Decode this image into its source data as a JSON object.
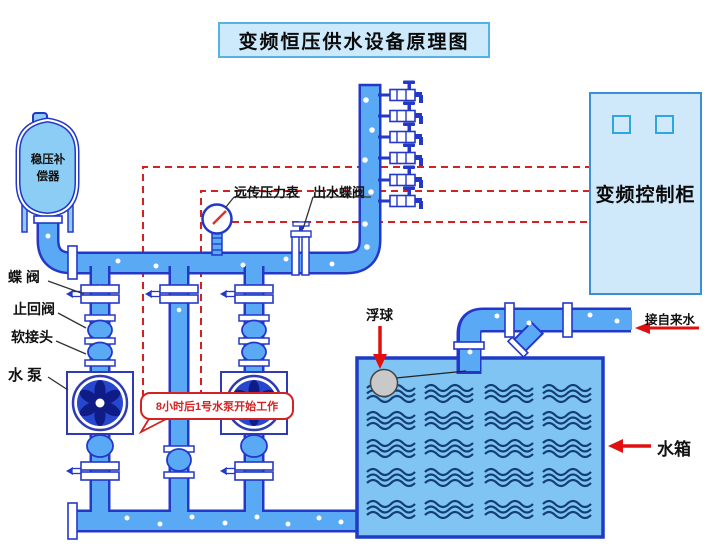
{
  "diagram": {
    "title": "变频恒压供水设备原理图",
    "labels": {
      "compensator": "稳压补\n偿器",
      "butterfly_valve": "蝶 阀",
      "check_valve": "止回阀",
      "flexible_joint": "软接头",
      "water_pump": "水 泵",
      "remote_pressure_gauge": "远传压力表",
      "outlet_butterfly_valve": "出水蝶阀",
      "float_ball": "浮球",
      "control_cabinet": "变频控制柜",
      "tap_water_inlet": "接自来水",
      "water_tank": "水箱"
    },
    "annotations": {
      "pump_start_note": "8小时后1号水泵开始工作"
    },
    "colors": {
      "pipe_fill": "#5aa9f4",
      "pipe_outline": "#2438c8",
      "tank_fill": "#7fc4f2",
      "panel_fill": "#cdeafc",
      "signal_red": "#d42222",
      "wave_navy": "#123e75",
      "impeller_navy": "#101c86"
    }
  }
}
